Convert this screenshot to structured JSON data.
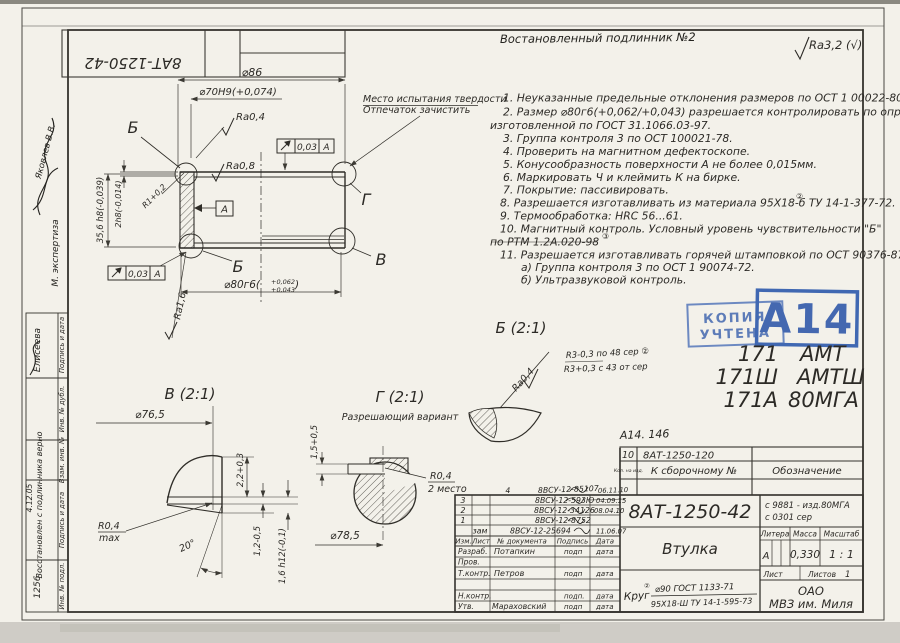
{
  "colors": {
    "paper": "#f3f1ea",
    "line": "#3b3933",
    "ink": "#24231f",
    "stamp_blue": "#4468b0"
  },
  "header": {
    "restored_note": "Востановленный подлинник №2",
    "general_roughness": "Ra3,2 (√)",
    "top_stamp_number": "8АТ-1250-42"
  },
  "notes": {
    "lines": [
      "1. Неуказанные предельные отклонения размеров по ОСТ 1 00022-80.",
      "2. Размер ⌀80г6(+0,062/+0,043) разрешается контролировать по оправке,",
      "изготовленной по ГОСТ 31.1066.03-97.",
      "3. Группа контроля 3 по ОСТ 100021-78.",
      "4. Проверить на магнитном дефектоскопе.",
      "5. Конусообразность поверхности А не более 0,015мм.",
      "6. Маркировать Ч и клеймить К на бирке.",
      "7. Покрытие: пассивировать.",
      "8. Разрешается изготавливать из материала 95Х18-б ТУ 14-1-377-72.",
      "9. Термообработка: HRC  56...61.",
      "10. Магнитный контроль. Условный уровень чувствительности \"Б\"",
      "по РТМ 1.2А.020-98",
      "11. Разрешается изготавливать горячей штамповкой по ОСТ 90376-87",
      "а) Группа контроля 3 по ОСТ 1 90074-72.",
      "б) Ультразвуковой контроль."
    ]
  },
  "rev_marks": {
    "mark2": "②",
    "mark3": "③"
  },
  "main_view": {
    "dim_86": "⌀86",
    "dim_70": "⌀70Н9(+0,074)",
    "ra04": "Ra0,4",
    "ra08": "Ra0,8",
    "ra16": "Ra1,6",
    "r1": "R1+0,2",
    "dim_356": "35,6 h8(-0,039)",
    "dim_2": "2h8(-0,014)",
    "dim_80_base": "⌀80г6(",
    "dim_80_top": "+0,062",
    "dim_80_bot": "+0,043",
    "dim_80_close": ")",
    "tol_value": "0,03",
    "tol_datum": "А",
    "datum_label": "А",
    "label_b": "Б",
    "label_b2": "Б",
    "label_g": "Г",
    "label_v": "В",
    "hardness_line1": "Место испытания твердости",
    "hardness_line2": "Отпечаток зачистить"
  },
  "view_v": {
    "title": "В (2:1)",
    "dim_765": "⌀76,5",
    "dim_22": "2,2+0,3",
    "r04": "R0,4",
    "r04_max": "max",
    "angle": "20°",
    "dim_12": "1,2-0,5",
    "dim_16": "1,6 h12(-0,1)"
  },
  "view_g": {
    "title": "Г (2:1)",
    "subtitle": "Разрешающий вариант",
    "dim_15": "1,5+0,5",
    "r04": "R0,4",
    "r04_note": "2 место",
    "dim_785": "⌀78,5"
  },
  "view_b": {
    "title": "Б (2:1)",
    "ra04": "Ra0,4",
    "hand_top": "R3-0,3  по 48 сер ②",
    "hand_bot": "R3+0,3  с 43 от сер"
  },
  "stamps": {
    "copy_1": "КОПИЯ",
    "copy_2": "УЧТЕНА",
    "big": "А14",
    "hand_ref": "А14. 146"
  },
  "type_list": {
    "rows": [
      {
        "c1": "171",
        "c2": "АМТ"
      },
      {
        "c1": "171Ш",
        "c2": "АМТШ"
      },
      {
        "c1": "171А",
        "c2": "80МГА"
      }
    ]
  },
  "parts_table": {
    "qty": "10",
    "part_no": "8АТ-1250-120",
    "qty_col": "Кол. на изд.",
    "assembly_col": "К сборочному №",
    "designation_col": "Обозначение"
  },
  "title_block": {
    "doc_number": "8АТ-1250-42",
    "applicability_1": "с 9881 - изд.80МГА",
    "applicability_2": "с 0301 сер",
    "part_name": "Втулка",
    "litera_label": "Литера",
    "mass_label": "Масса",
    "scale_label": "Масштаб",
    "litera": "А",
    "mass": "0,330",
    "scale": "1 : 1",
    "sheet_label": "Лист",
    "sheets_label": "Листов",
    "sheets": "1",
    "material_prefix": "Круг",
    "material_top": "⌀90 ГОСТ 1133-71",
    "material_bottom": "95Х18-Ш ТУ 14-1-595-73",
    "company_1": "ОАО",
    "company_2": "МВЗ им. Миля",
    "header": {
      "izm": "Изм.",
      "list": "Лист",
      "doc": "№ документа",
      "sign": "Подпись",
      "date": "Дата"
    },
    "changes": [
      {
        "num": "4",
        "doc": "8ВСУ-12-85107",
        "date": "06.11.10"
      },
      {
        "num": "3",
        "doc": "8ВСУ-12-593Ю",
        "date": "04.09.15"
      },
      {
        "num": "2",
        "doc": "8ВСУ-12-34126",
        "date": "08.04.10"
      },
      {
        "num": "1",
        "doc": "8ВСУ-12-8752",
        "date": ""
      },
      {
        "num": "зам",
        "doc": "8ВСУ-12-25694",
        "date": "11.06.07"
      }
    ],
    "roles": [
      {
        "role": "Разраб.",
        "name": "Потапкин",
        "sign": "подп",
        "date": "дата"
      },
      {
        "role": "Пров.",
        "name": "",
        "sign": "",
        "date": ""
      },
      {
        "role": "Т.контр.",
        "name": "Петров",
        "sign": "подп",
        "date": "дата"
      },
      {
        "role": "Н.контр.",
        "name": "",
        "sign": "подп.",
        "date": "дата"
      },
      {
        "role": "Утв.",
        "name": "Мараховский",
        "sign": "подп",
        "date": "дата"
      }
    ]
  },
  "left_margin": {
    "restored": "Восстановлен с подлинника верно",
    "restored_by": "Елисеева",
    "expertise": "М. экспертиза",
    "expert_name": "Яковлев В.В.",
    "cells": [
      {
        "label": "Подпись и дата",
        "value": ""
      },
      {
        "label": "Инв. № дубл.",
        "value": ""
      },
      {
        "label": "Взам. инв. №",
        "value": ""
      },
      {
        "label": "Подпись и дата",
        "value": "4.12.05"
      },
      {
        "label": "Инв. № подл.",
        "value": "1256"
      }
    ]
  }
}
